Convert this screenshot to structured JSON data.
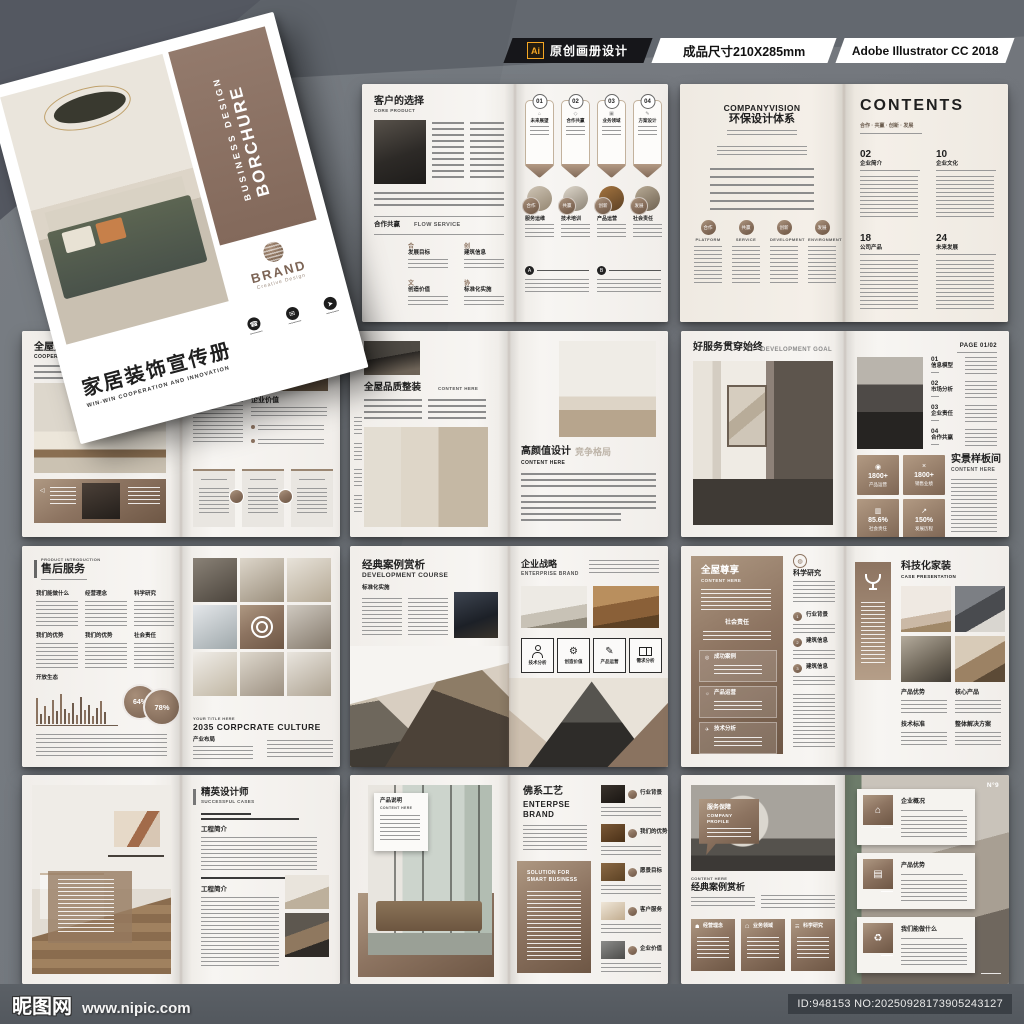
{
  "palette": {
    "background": "#70757b",
    "page": "#f6f4f1",
    "accent_brown": "#8d7461",
    "topbar_black": "#16161a",
    "ai_orange": "#f5a623"
  },
  "header": {
    "ai_label": "Ai",
    "badge_text": "原创画册设计",
    "size_text": "成品尺寸210X285mm",
    "software_text": "Adobe Illustrator CC 2018"
  },
  "footer": {
    "site_name": "昵图网",
    "site_url": "www.nipic.com",
    "id_text": "ID:948153 NO:20250928173905243127"
  },
  "cover": {
    "vertical_title_small": "BUSINESS DESIGN",
    "vertical_title_big": "BORCHURE",
    "brand_name": "BRAND",
    "brand_sub": "Creative Design",
    "title": "家居装饰宣传册",
    "subtitle": "WIN-WIN COOPERATION AND INNOVATION"
  },
  "s1m": {
    "left": {
      "title": "客户的选择",
      "subtitle": "CORE PRODUCT",
      "section_cn": "合作共赢",
      "section_en": "FLOW SERVICE",
      "flow": [
        {
          "icon": "合",
          "label": "发展目标"
        },
        {
          "icon": "创",
          "label": "建筑信息"
        },
        {
          "icon": "文",
          "label": "创造价值"
        },
        {
          "icon": "协",
          "label": "标准化实施"
        }
      ]
    },
    "right": {
      "badges": [
        {
          "num": "01",
          "label": "未来展望"
        },
        {
          "num": "02",
          "label": "合作共赢"
        },
        {
          "num": "03",
          "label": "业务领域"
        },
        {
          "num": "04",
          "label": "方案设计"
        }
      ],
      "circles": [
        {
          "tag": "合作",
          "label": "服务运维"
        },
        {
          "tag": "共赢",
          "label": "技术培训"
        },
        {
          "tag": "创新",
          "label": "产品运营"
        },
        {
          "tag": "发展",
          "label": "社会责任"
        }
      ],
      "bullet_a": "A",
      "bullet_b": "B"
    }
  },
  "s1r": {
    "left": {
      "title_en": "COMPANYVISION",
      "title": "环保设计体系",
      "circles": [
        {
          "tag": "合作",
          "label": "PLATFORM"
        },
        {
          "tag": "共赢",
          "label": "SERVICE"
        },
        {
          "tag": "创新",
          "label": "DEVELOPMENT"
        },
        {
          "tag": "发展",
          "label": "ENVIRONMENT"
        }
      ]
    },
    "right": {
      "title": "CONTENTS",
      "tagline": "合作 · 共赢 · 创新 · 发展",
      "sections": [
        {
          "num": "02",
          "label": "企业简介"
        },
        {
          "num": "10",
          "label": "企业文化"
        },
        {
          "num": "18",
          "label": "公司产品"
        },
        {
          "num": "24",
          "label": "未来发展"
        }
      ]
    }
  },
  "s2l": {
    "left": {
      "title": "全屋定制",
      "subtitle": "COOPERATION AND WIN-WIN"
    },
    "right": {
      "eyebrow1": "DEVELOP",
      "eyebrow2": "VISION",
      "section": "企业价值"
    }
  },
  "s2m": {
    "left": {
      "title": "全屋品质整装",
      "subtitle": "CONTENT HERE"
    },
    "right": {
      "title": "高颜值设计",
      "ghost": "竞争格局",
      "subtitle": "CONTENT HERE"
    }
  },
  "s2r": {
    "left": {
      "title": "好服务贯穿始终",
      "title_en": "DEVELOPMENT GOAL"
    },
    "right": {
      "page_label": "PAGE 01/02",
      "items": [
        {
          "num": "01",
          "label": "信息模型"
        },
        {
          "num": "02",
          "label": "市场分析"
        },
        {
          "num": "03",
          "label": "企业责任"
        },
        {
          "num": "04",
          "label": "合作共赢"
        }
      ],
      "stats": [
        {
          "value": "1800+",
          "label": "产品运营"
        },
        {
          "value": "1800+",
          "label": "销售业绩"
        },
        {
          "value": "85.6%",
          "label": "社会责任"
        },
        {
          "value": "150%",
          "label": "发展历程"
        }
      ],
      "section": "实景样板间",
      "section_en": "CONTENT HERE"
    }
  },
  "s3l": {
    "left": {
      "eyebrow": "PRODUCT INTRODUCTION",
      "title": "售后服务",
      "heads": [
        "我们能做什么",
        "经营理念",
        "科学研究",
        "我们的优势",
        "我们的优势",
        "社会责任"
      ],
      "eco": "开放生态",
      "pct1": "64%",
      "pct2": "78%"
    },
    "right": {
      "title": "大宅设计",
      "sub": "YOUR TITLE HERE",
      "en": "2035 CORPCRATE CULTURE",
      "section": "产业布局"
    }
  },
  "s3m": {
    "left": {
      "title": "经典案例赏析",
      "subtitle": "DEVELOPMENT COURSE",
      "tag": "标准化实施"
    },
    "right": {
      "title": "企业战略",
      "subtitle": "ENTERPRISE BRAND",
      "boxes": [
        "技术分析",
        "创造价值",
        "产品运营",
        "需求分析"
      ]
    }
  },
  "s3r": {
    "left": {
      "title": "全屋尊享",
      "subtitle": "CONTENT HERE",
      "badge": "社会责任",
      "boxes": [
        "成功案例",
        "产品运营",
        "技术分析"
      ],
      "col_title": "科学研究",
      "bullets": [
        {
          "num": "1",
          "label": "行业背景"
        },
        {
          "num": "2",
          "label": "建筑信息"
        },
        {
          "num": "3",
          "label": "建筑信息"
        }
      ]
    },
    "right": {
      "title": "科技化家装",
      "subtitle": "CASE PRESENTATION",
      "labels": [
        "产品优势",
        "核心产品",
        "技术标准",
        "整体解决方案"
      ]
    }
  },
  "s4l": {
    "right": {
      "title": "精英设计师",
      "subtitle": "SUCCESSFUL CASES",
      "sec1": "工程简介",
      "sec2": "工程简介"
    }
  },
  "s4m": {
    "left": {
      "tag_title": "产品说明",
      "tag_sub": "CONTENT HERE"
    },
    "right": {
      "title": "佛系工艺",
      "en1": "ENTERPSE",
      "en2": "BRAND",
      "panel1": "SOLUTION FOR",
      "panel2": "SMART BUSINESS",
      "items": [
        "行业背景",
        "我们的优势",
        "愿景目标",
        "客户服务",
        "企业价值"
      ]
    }
  },
  "s4r": {
    "left": {
      "tag_title": "服务保障",
      "tag_en1": "COMPANY",
      "tag_en2": "PROFILE",
      "eyebrow": "CONTENT HERE",
      "title": "经典案例赏析",
      "boxes": [
        "经营理念",
        "业务领域",
        "科学研究"
      ]
    },
    "right": {
      "page_no": "N°9",
      "cards": [
        "企业概况",
        "产品优势",
        "我们能做什么"
      ]
    }
  }
}
